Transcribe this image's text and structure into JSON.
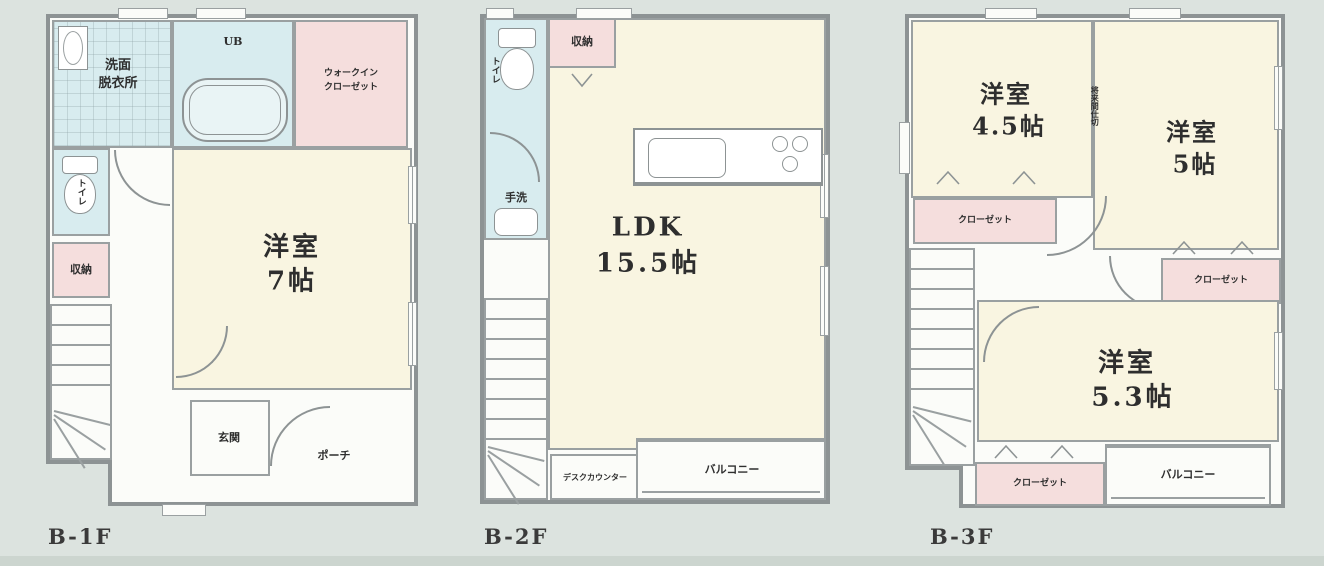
{
  "colors": {
    "background": "#dce3df",
    "paper": "#fbfcf9",
    "wall": "#8d9394",
    "room_cream": "#f9f5e1",
    "room_pink": "#f5dedd",
    "room_blue": "#d8ecef",
    "text": "#2e2e2e"
  },
  "floors": [
    {
      "label": "B-1F",
      "rooms": {
        "washroom_l1": "洗面",
        "washroom_l2": "脱衣所",
        "bath": "UB",
        "wic_l1": "ウォークイン",
        "wic_l2": "クローゼット",
        "toilet": "トイレ",
        "storage": "収納",
        "bedroom_l1": "洋室",
        "bedroom_l2": "7帖",
        "entrance": "玄関",
        "porch": "ポーチ"
      }
    },
    {
      "label": "B-2F",
      "rooms": {
        "toilet": "トイレ",
        "storage": "収納",
        "handwash": "手洗",
        "ldk_l1": "LDK",
        "ldk_l2": "15.5帖",
        "desk_counter": "デスクカウンター",
        "balcony": "バルコニー"
      }
    },
    {
      "label": "B-3F",
      "rooms": {
        "bedroom45_l1": "洋室",
        "bedroom45_l2": "4.5帖",
        "bedroom5_l1": "洋室",
        "bedroom5_l2": "5帖",
        "partition_note": "将来間仕切",
        "closet_a": "クローゼット",
        "closet_b": "クローゼット",
        "bedroom53_l1": "洋室",
        "bedroom53_l2": "5.3帖",
        "closet_c": "クローゼット",
        "balcony": "バルコニー"
      }
    }
  ]
}
